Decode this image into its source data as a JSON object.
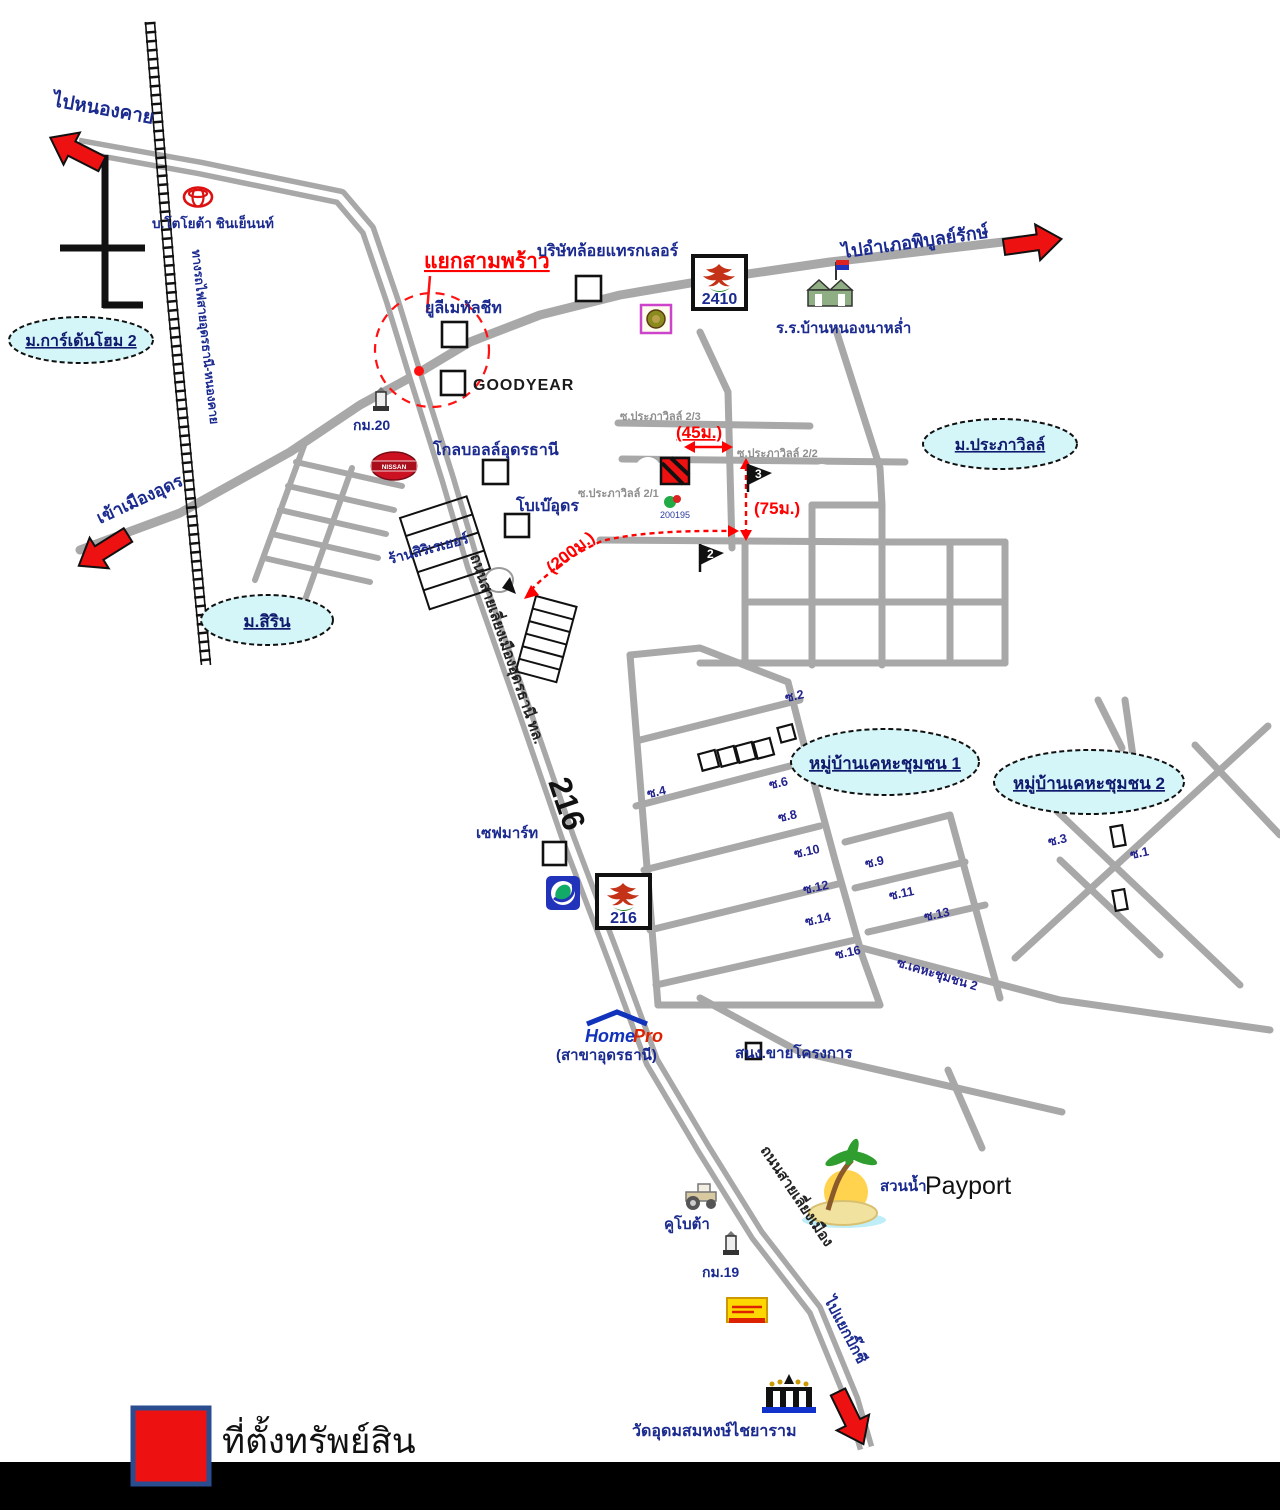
{
  "colors": {
    "road_gray": "#a8a8a8",
    "arrow_red": "#ee1111",
    "village_fill": "#d5f6f8",
    "label_navy": "#1a2a8f",
    "distance_red": "#ff0000"
  },
  "arrows": {
    "to_nongkhai": "ไปหนองคาย",
    "to_phibun": "ไปอำเภอพิบูลย์รักษ์",
    "to_mueang_udon": "เข้าเมืองอุดร",
    "to_bigc": "ไปแยกบิ๊กซี"
  },
  "routes": {
    "r2410": "2410",
    "r216": "216",
    "bypass_prefix": "ถนนสายเลี่ยงเมืองอุดรธานี ทล.",
    "bypass_lower": "ถนนสายเลี่ยงเมือง",
    "railway": "ทางรถไฟสายอุดรธานี-หนองคาย"
  },
  "junction": {
    "samphrao": "แยกสามพร้าว"
  },
  "villages": {
    "gardenhome": "ม.การ์เด้นโฮม 2",
    "sirin": "ม.สิริน",
    "prapawill": "ม.ประภาวิลล์",
    "kheha1": "หมู่บ้านเคหะชุมชน 1",
    "kheha2": "หมู่บ้านเคหะชุมชน 2"
  },
  "distances": {
    "d45": "(45ม.)",
    "d75": "(75ม.)",
    "d200": "(200ม.)"
  },
  "places": {
    "toyota": "บ.โตโยต้า ชินเย็นนท์",
    "trailer": "บริษัทล้อยแทรกเลอร์",
    "metal_sheet": "ยูลีเมทัลชีท",
    "goodyear": "GOODYEAR",
    "global": "โกลบอลล์อุดรธานี",
    "bobae": "โบเบ๊อุดร",
    "siri_shop": "ร้านสิริเรเยอร์",
    "school": "ร.ร.บ้านหนองนาหล่ำ",
    "savemart": "เซฟมาร์ท",
    "sales_office": "สนง.ขายโครงการ",
    "kubota": "คูโบต้า",
    "temple": "วัดอุดมสมหงษ์ไชยาราม",
    "waterpark_th": "สวนน้ำ",
    "waterpark_en": "Payport",
    "homepro_home": "Home",
    "homepro_pro": "Pro",
    "homepro_branch": "(สาขาอุดรธานี)",
    "nissan": "NISSAN",
    "km20": "กม.20",
    "km19": "กม.19",
    "marker_no": "200195"
  },
  "sois": {
    "prapha_top": "ซ.ประภาวิลล์ 2/3",
    "prapha_mid": "ซ.ประภาวิลล์ 2/2",
    "prapha_low": "ซ.ประภาวิลล์ 2/1",
    "s1": "ซ.1",
    "s2": "ซ.2",
    "s3": "ซ.3",
    "s4": "ซ.4",
    "s6": "ซ.6",
    "s8": "ซ.8",
    "s9": "ซ.9",
    "s10": "ซ.10",
    "s11": "ซ.11",
    "s12": "ซ.12",
    "s13": "ซ.13",
    "s14": "ซ.14",
    "s16": "ซ.16",
    "kheha2_soi": "ซ.เคหะชุมชน 2"
  },
  "flags": {
    "f2": "2",
    "f3": "3"
  },
  "legend": {
    "property": "ที่ตั้งทรัพย์สิน"
  }
}
